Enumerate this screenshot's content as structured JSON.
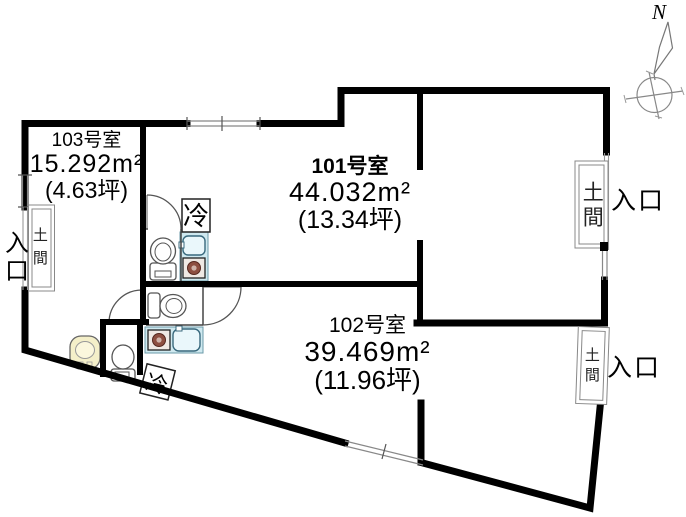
{
  "rooms": [
    {
      "id": "101",
      "name": "101号室",
      "area_m2": "44.032m²",
      "area_tsubo": "(13.34坪)"
    },
    {
      "id": "102",
      "name": "102号室",
      "area_m2": "39.469m²",
      "area_tsubo": "(11.96坪)"
    },
    {
      "id": "103",
      "name": "103号室",
      "area_m2": "15.292m²",
      "area_tsubo": "(4.63坪)"
    }
  ],
  "labels": {
    "entrance": "入口",
    "doma": "土間",
    "refrigerator": "冷",
    "north": "N"
  },
  "colors": {
    "wall": "#000000",
    "thin_line": "#555555",
    "counter_fill": "#cfe9f0",
    "sink_fill": "#eaf7fb",
    "stove_burner": "#8d4f41",
    "fixture_cream": "#f4efc9",
    "background": "#ffffff"
  }
}
